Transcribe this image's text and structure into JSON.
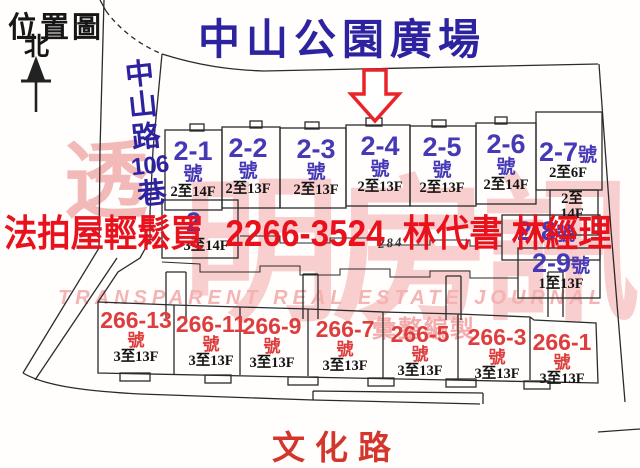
{
  "colors": {
    "navy_title": "#2d23a0",
    "unit_blue": "#4639b6",
    "bottom_red": "#dd3d3d",
    "overlay_red": "#e9111c",
    "road_red": "#d3362c",
    "line_dark": "#2b2b2b",
    "watermark_pink": "#f2a8a8"
  },
  "header": {
    "map_type": "位置圖",
    "north": "北"
  },
  "places": {
    "park": "中山公園廣場",
    "left_road": "中山路106巷",
    "left_road_chars": [
      "中",
      "山",
      "路",
      "106",
      "巷"
    ],
    "bottom_road": "文化路",
    "plot_number": "284"
  },
  "overlay": {
    "slogan": "法拍屋輕鬆買",
    "phone": "2266-3524",
    "contacts": "林代書 林經理"
  },
  "watermark": {
    "cjk_first": "透",
    "cjk_rest": "明房訊",
    "latin": "TRANSPARENT REAL ESTATE JOURNAL",
    "note": "彙整編製"
  },
  "units_top": [
    {
      "num": "2-1",
      "suffix": "號",
      "floors": "2至14F"
    },
    {
      "num": "2-2",
      "suffix": "號",
      "floors": "2至13F"
    },
    {
      "num": "2-3",
      "suffix": "號",
      "floors": "2至13F"
    },
    {
      "num": "2-4",
      "suffix": "號",
      "floors": "2至13F"
    },
    {
      "num": "2-5",
      "suffix": "號",
      "floors": "2至13F"
    },
    {
      "num": "2-6",
      "suffix": "號",
      "floors": "2至14F"
    }
  ],
  "units_right": {
    "u27": {
      "num": "2-7",
      "suffix": "號",
      "floors": "2至6F"
    },
    "aux": {
      "line1": "2至",
      "line2": "14F"
    },
    "u28": {
      "num": "2-8",
      "suffix": "號"
    },
    "u29": {
      "num": "2-9",
      "suffix": "號",
      "floors": "1至13F"
    }
  },
  "unit_west": {
    "partial_num": "2",
    "floors": "3至14F"
  },
  "units_bottom": [
    {
      "num": "266-13",
      "suffix": "號",
      "floors": "3至13F"
    },
    {
      "num": "266-11",
      "suffix": "號",
      "floors": "3至13F"
    },
    {
      "num": "266-9",
      "suffix": "號",
      "floors": "3至13F"
    },
    {
      "num": "266-7",
      "suffix": "號",
      "floors": "3至13F"
    },
    {
      "num": "266-5",
      "suffix": "號",
      "floors": "3至13F"
    },
    {
      "num": "266-3",
      "suffix": "號",
      "floors": "3至13F"
    },
    {
      "num": "266-1",
      "suffix": "號",
      "floors": "3至13F"
    }
  ]
}
